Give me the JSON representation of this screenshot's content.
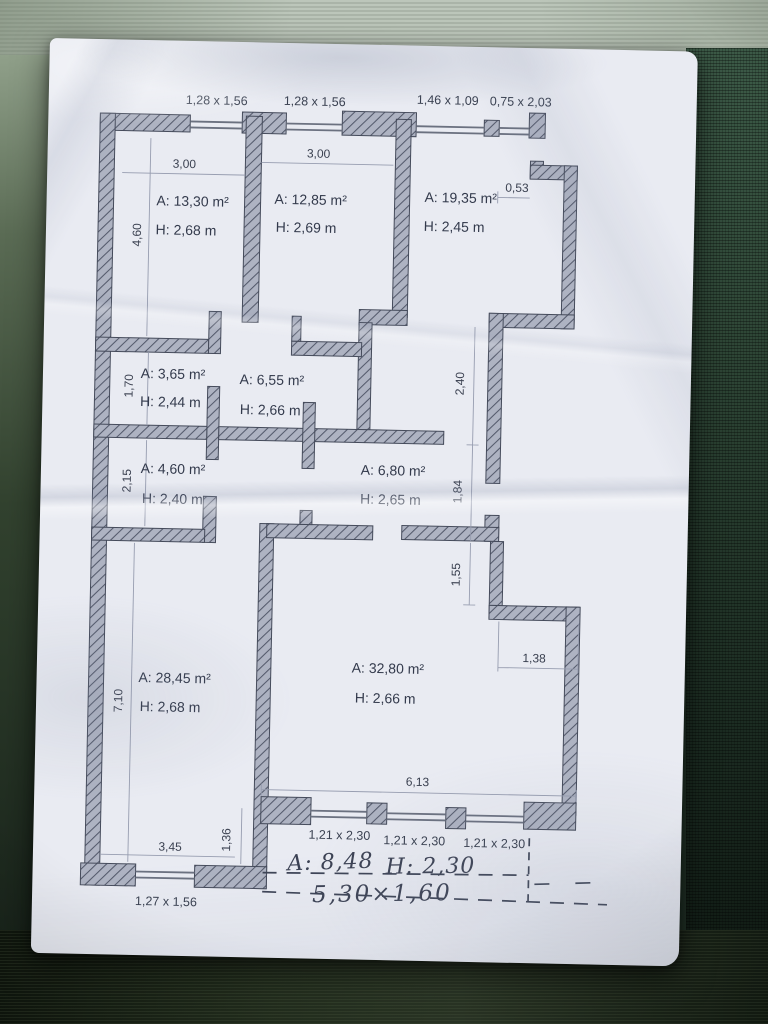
{
  "scene": {
    "description": "photo of crumpled paper floor plan on dark green ribbed table",
    "colors": {
      "paper": "#e9ebf2",
      "wall_hatch": "#aeb3c2",
      "ink": "#353b4d",
      "table_dark": "#1b2a21",
      "table_light": "#b3bdb1"
    }
  },
  "plan": {
    "window_labels_top": [
      "1,28 x 1,56",
      "1,28 x 1,56",
      "1,46 x 1,09",
      "0,75 x 2,03"
    ],
    "window_labels_bottom": [
      "1,21 x 2,30",
      "1,21 x 2,30",
      "1,21 x 2,30"
    ],
    "window_label_bottom_left": "1,27 x 1,56",
    "rooms": [
      {
        "name": "room-top-left",
        "area": "A: 13,30 m²",
        "height": "H: 2,68 m"
      },
      {
        "name": "room-top-middle",
        "area": "A: 12,85 m²",
        "height": "H: 2,69 m"
      },
      {
        "name": "room-top-right",
        "area": "A: 19,35 m²",
        "height": "H: 2,45 m"
      },
      {
        "name": "room-small-left",
        "area": "A: 3,65 m²",
        "height": "H: 2,44 m"
      },
      {
        "name": "hall-middle",
        "area": "A: 6,55 m²",
        "height": "H: 2,66 m"
      },
      {
        "name": "room-wc",
        "area": "A: 4,60 m²",
        "height": "H: 2,40 m"
      },
      {
        "name": "hall-lower",
        "area": "A: 6,80 m²",
        "height": "H: 2,65 m"
      },
      {
        "name": "room-bottom-left",
        "area": "A: 28,45 m²",
        "height": "H: 2,68 m"
      },
      {
        "name": "room-living",
        "area": "A: 32,80 m²",
        "height": "H: 2,66 m"
      }
    ],
    "dimensions": {
      "room1_width": "3,00",
      "room2_width": "3,00",
      "notch_width": "0,53",
      "left_upper": "4,60",
      "small_room_h": "1,70",
      "wc_h": "2,15",
      "corridor_upper": "2,40",
      "corridor_door": "1,84",
      "step_h": "1,55",
      "step_w": "1,38",
      "left_lower": "7,10",
      "living_width": "6,13",
      "bottom_left_w": "3,45",
      "bottom_offset": "1,36"
    },
    "handwritten": {
      "balcony_area": "A: 8,48",
      "balcony_height": "H: 2,30",
      "balcony_size": "5,30×1,60"
    }
  }
}
